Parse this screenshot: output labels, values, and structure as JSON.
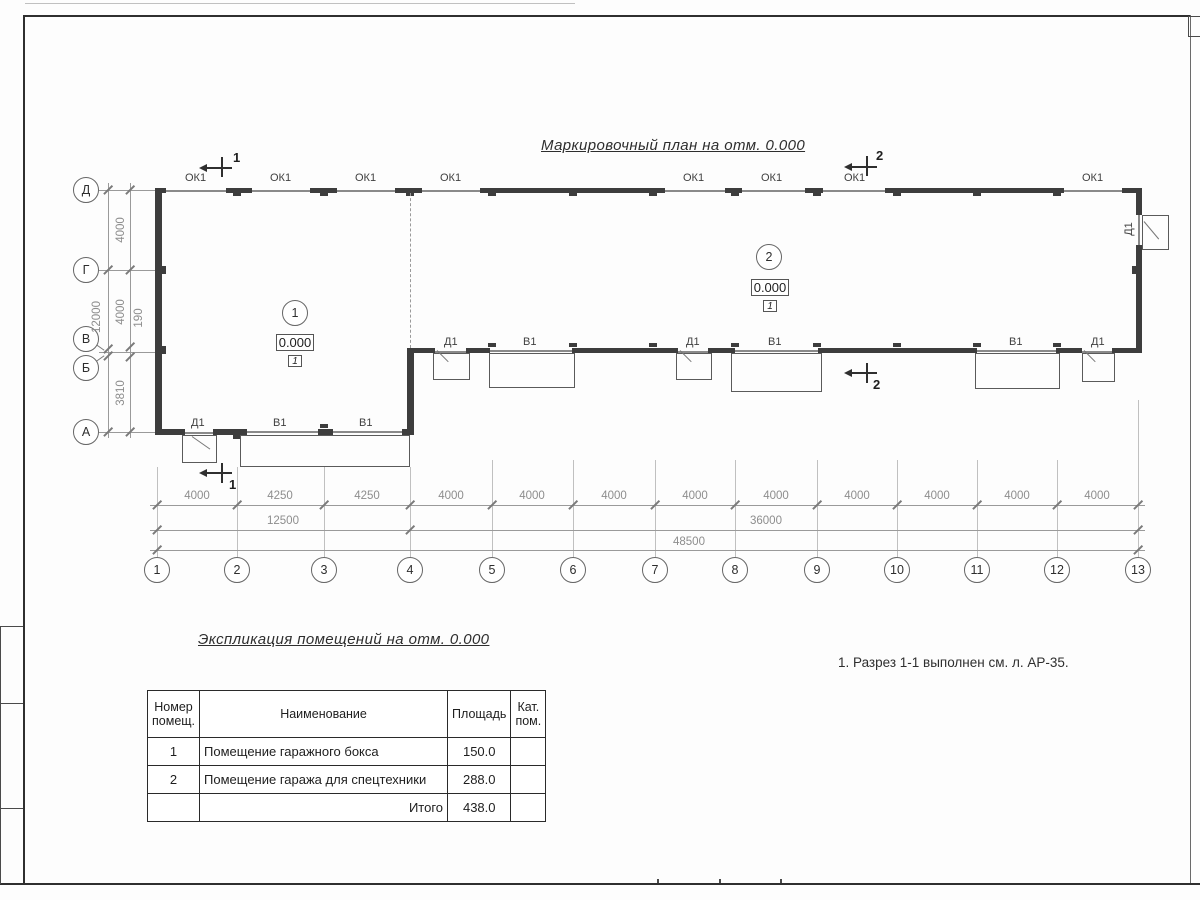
{
  "titles": {
    "plan_title": "Маркировочный план на отм. 0.000",
    "table_title": "Экспликация помещений на отм. 0.000",
    "note": "1. Разрез 1-1 выполнен см. л. АР-35."
  },
  "plan": {
    "row_axes": [
      "Д",
      "Г",
      "В",
      "Б",
      "А"
    ],
    "col_axes": [
      "1",
      "2",
      "3",
      "4",
      "5",
      "6",
      "7",
      "8",
      "9",
      "10",
      "11",
      "12",
      "13"
    ],
    "left_dims": {
      "d_g": "4000",
      "g_v": "4000",
      "v_b": "190",
      "b_a": "3810",
      "total": "12000"
    },
    "bottom_dims_row1": [
      "4000",
      "4250",
      "4250",
      "4000",
      "4000",
      "4000",
      "4000",
      "4000",
      "4000",
      "4000",
      "4000",
      "4000"
    ],
    "bottom_dims_row2": [
      "12500",
      "36000"
    ],
    "bottom_dims_total": "48500",
    "ok1_labels": [
      "ОК1",
      "ОК1",
      "ОК1",
      "ОК1",
      "ОК1",
      "ОК1",
      "ОК1",
      "ОК1"
    ],
    "a_wall_labels": [
      "Д1",
      "В1",
      "В1"
    ],
    "b_wall_labels": [
      "Д1",
      "В1",
      "Д1",
      "В1",
      "В1",
      "Д1"
    ],
    "right_door_label": "Д1",
    "sections": {
      "s1": "1",
      "s2": "2"
    },
    "rooms": [
      {
        "number": "1",
        "elevation": "0.000",
        "floor_type": "1"
      },
      {
        "number": "2",
        "elevation": "0.000",
        "floor_type": "1"
      }
    ]
  },
  "table": {
    "headers": {
      "num": "Номер помещ.",
      "name": "Наименование",
      "area": "Площадь",
      "cat": "Кат. пом."
    },
    "rows": [
      {
        "num": "1",
        "name": "Помещение гаражного бокса",
        "area": "150.0",
        "cat": ""
      },
      {
        "num": "2",
        "name": "Помещение гаража для спецтехники",
        "area": "288.0",
        "cat": ""
      }
    ],
    "total_label": "Итого",
    "total_area": "438.0"
  }
}
